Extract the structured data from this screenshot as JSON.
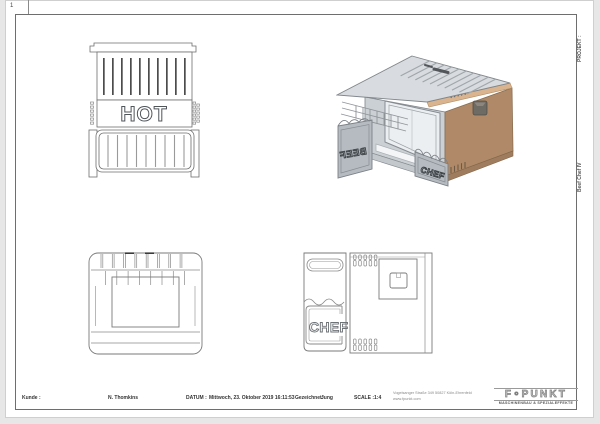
{
  "sheet": {
    "zone_label": "1",
    "margin": {
      "project_label": "PROJEKT :",
      "project_value": "Beef Chef IV"
    }
  },
  "views": {
    "front_view": {
      "panel_text": "HOT"
    },
    "iso_view": {
      "front_flap_text": "CHEF",
      "side_flap_text": "BEEF"
    },
    "side_view": {
      "flap_text": "CHEF"
    }
  },
  "title_block": {
    "customer_label": "Kunde :",
    "customer_name": "N. Thomkins",
    "date_label": "DATUM :",
    "date_value": "Mittwoch, 23. Oktober 2019 16:11:53",
    "drawn_by_label": "Gezeichnet:",
    "drawn_by_value": "Jung",
    "scale_label": "SCALE :",
    "scale_value": "1:4",
    "company": {
      "address": "Vogelsanger Straße 349 50827 Köln-Ehrenfeld",
      "website": "www.fpunkt.com",
      "logo_text": "F∘PUNKT",
      "logo_subtitle": "MASCHINENBAU & SPEZIALEFFEKTE"
    }
  },
  "colors": {
    "paper": "#ffffff",
    "background": "#e7e7e7",
    "frame_line": "#6e6e6e",
    "drawing_line": "#787878",
    "dark_detail": "#4a4a4a",
    "iso_brown": "#b08a68",
    "iso_copper": "#d9b48e",
    "iso_gray_light": "#d8dce0",
    "iso_gray_mid": "#cbd0d5",
    "iso_gray_flap": "#b5bbc1"
  }
}
